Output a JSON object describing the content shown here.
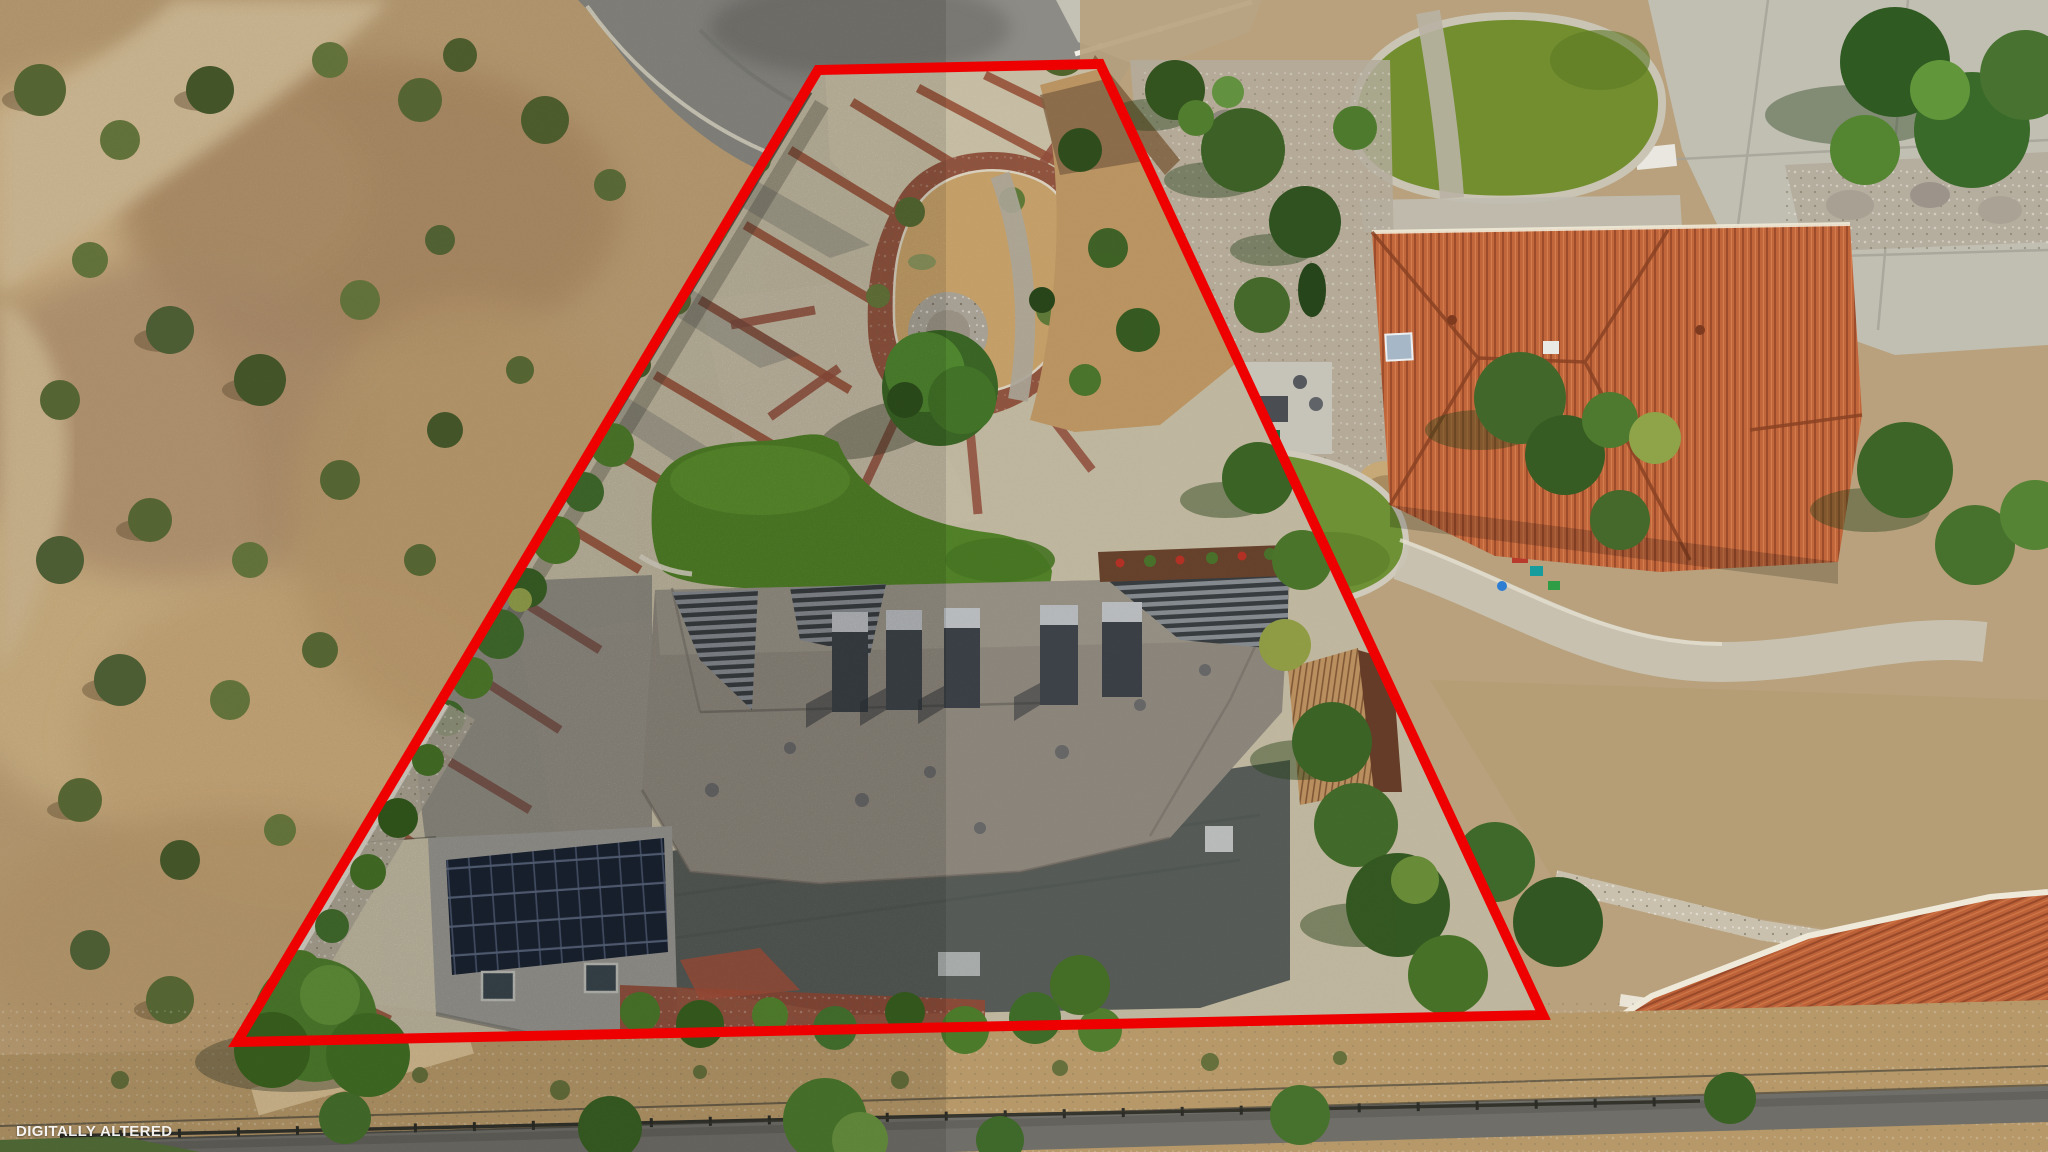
{
  "watermark": {
    "label": "DIGITALLY ALTERED"
  },
  "boundary": {
    "color": "#ee0000"
  }
}
